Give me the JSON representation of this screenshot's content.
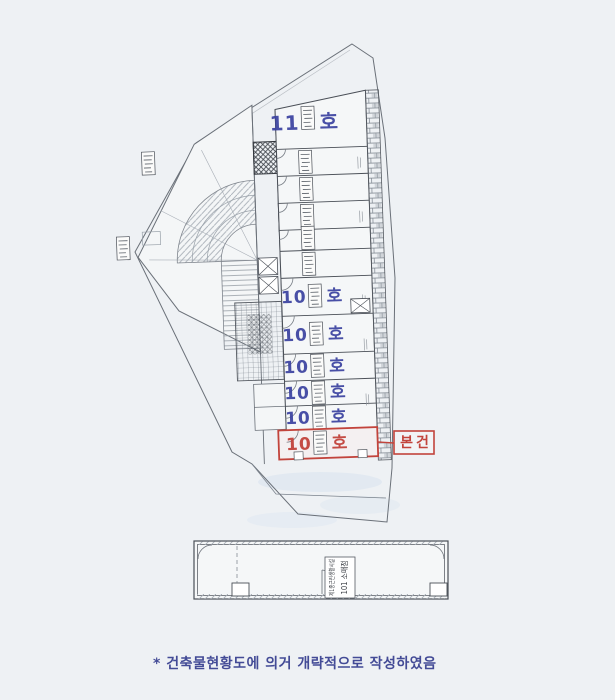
{
  "document": {
    "caption": "* 건축물현황도에 의거 개략적으로 작성하였음",
    "paper_color": "#eef1f4"
  },
  "colors": {
    "plan_line": "#4a4f57",
    "faint_line": "#9aa1a9",
    "unit_label_blue": "#3a41a0",
    "highlight_red": "#c2443c"
  },
  "main_plan": {
    "units": [
      {
        "prefix": "11",
        "suffix": "호"
      },
      {
        "prefix": "10",
        "suffix": "호"
      },
      {
        "prefix": "10",
        "suffix": "호"
      },
      {
        "prefix": "10",
        "suffix": "호"
      },
      {
        "prefix": "10",
        "suffix": "호"
      },
      {
        "prefix": "10",
        "suffix": "호"
      },
      {
        "prefix": "10",
        "suffix": "호",
        "highlighted": true
      }
    ],
    "subject_marker_label": "본건"
  },
  "bottom_plan": {
    "unit_use_label": "101 소매점",
    "facility_type_label": "제1종근린생활시설"
  }
}
